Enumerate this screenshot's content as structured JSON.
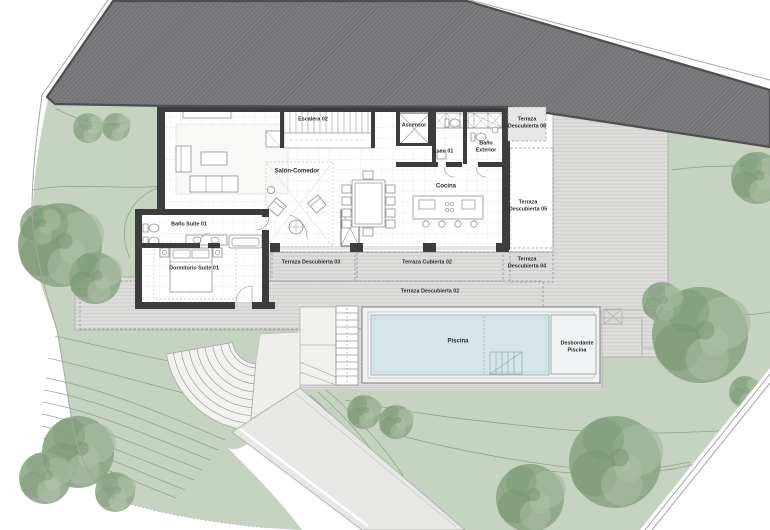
{
  "plan": {
    "title": "Planta Vivienda - Piscina",
    "rooms": {
      "escalera": "Escalera 02",
      "ascensor": "Ascensor",
      "aseo": "Aseo 01",
      "bano_exterior": "Baño\nExterior",
      "salon_comedor": "Salón-Comedor",
      "cocina": "Cocina",
      "bano_suite": "Baño Suite 01",
      "dormitorio_suite": "Dormitorio Suite 01"
    },
    "terraces": {
      "td02": "Terraza Descubierta 02",
      "td03": "Terraza Descubierta 03",
      "tc02": "Terraza Cubierta 02",
      "td04": "Terraza\nDescubierta 04",
      "td05": "Terraza\nDescubierta 05",
      "td06": "Terraza\nDescubierta 06"
    },
    "pool": {
      "piscina": "Piscina",
      "desbordante": "Desbordante\nPiscina"
    }
  },
  "colors": {
    "roof": "#7d7d80",
    "roof_hatch": "#626265",
    "wall": "#3d3d3f",
    "garden": "#c6d3c1",
    "tree": "#8ea889",
    "tree_light": "#a6bba0",
    "tree_dark": "#73906e",
    "deck": "#dedddc",
    "deck_stripe": "#cbcbc9",
    "deck_edge": "#b3b3b1",
    "grid": "#e3e5e8",
    "pool_water": "#d5e5e8",
    "furniture": "#8e8e90",
    "dash": "#8f8f91",
    "contour": "#87997f",
    "boundary": "#a5a5a3",
    "label": "#2b2b2d",
    "path_fill": "#e7e7e5"
  }
}
